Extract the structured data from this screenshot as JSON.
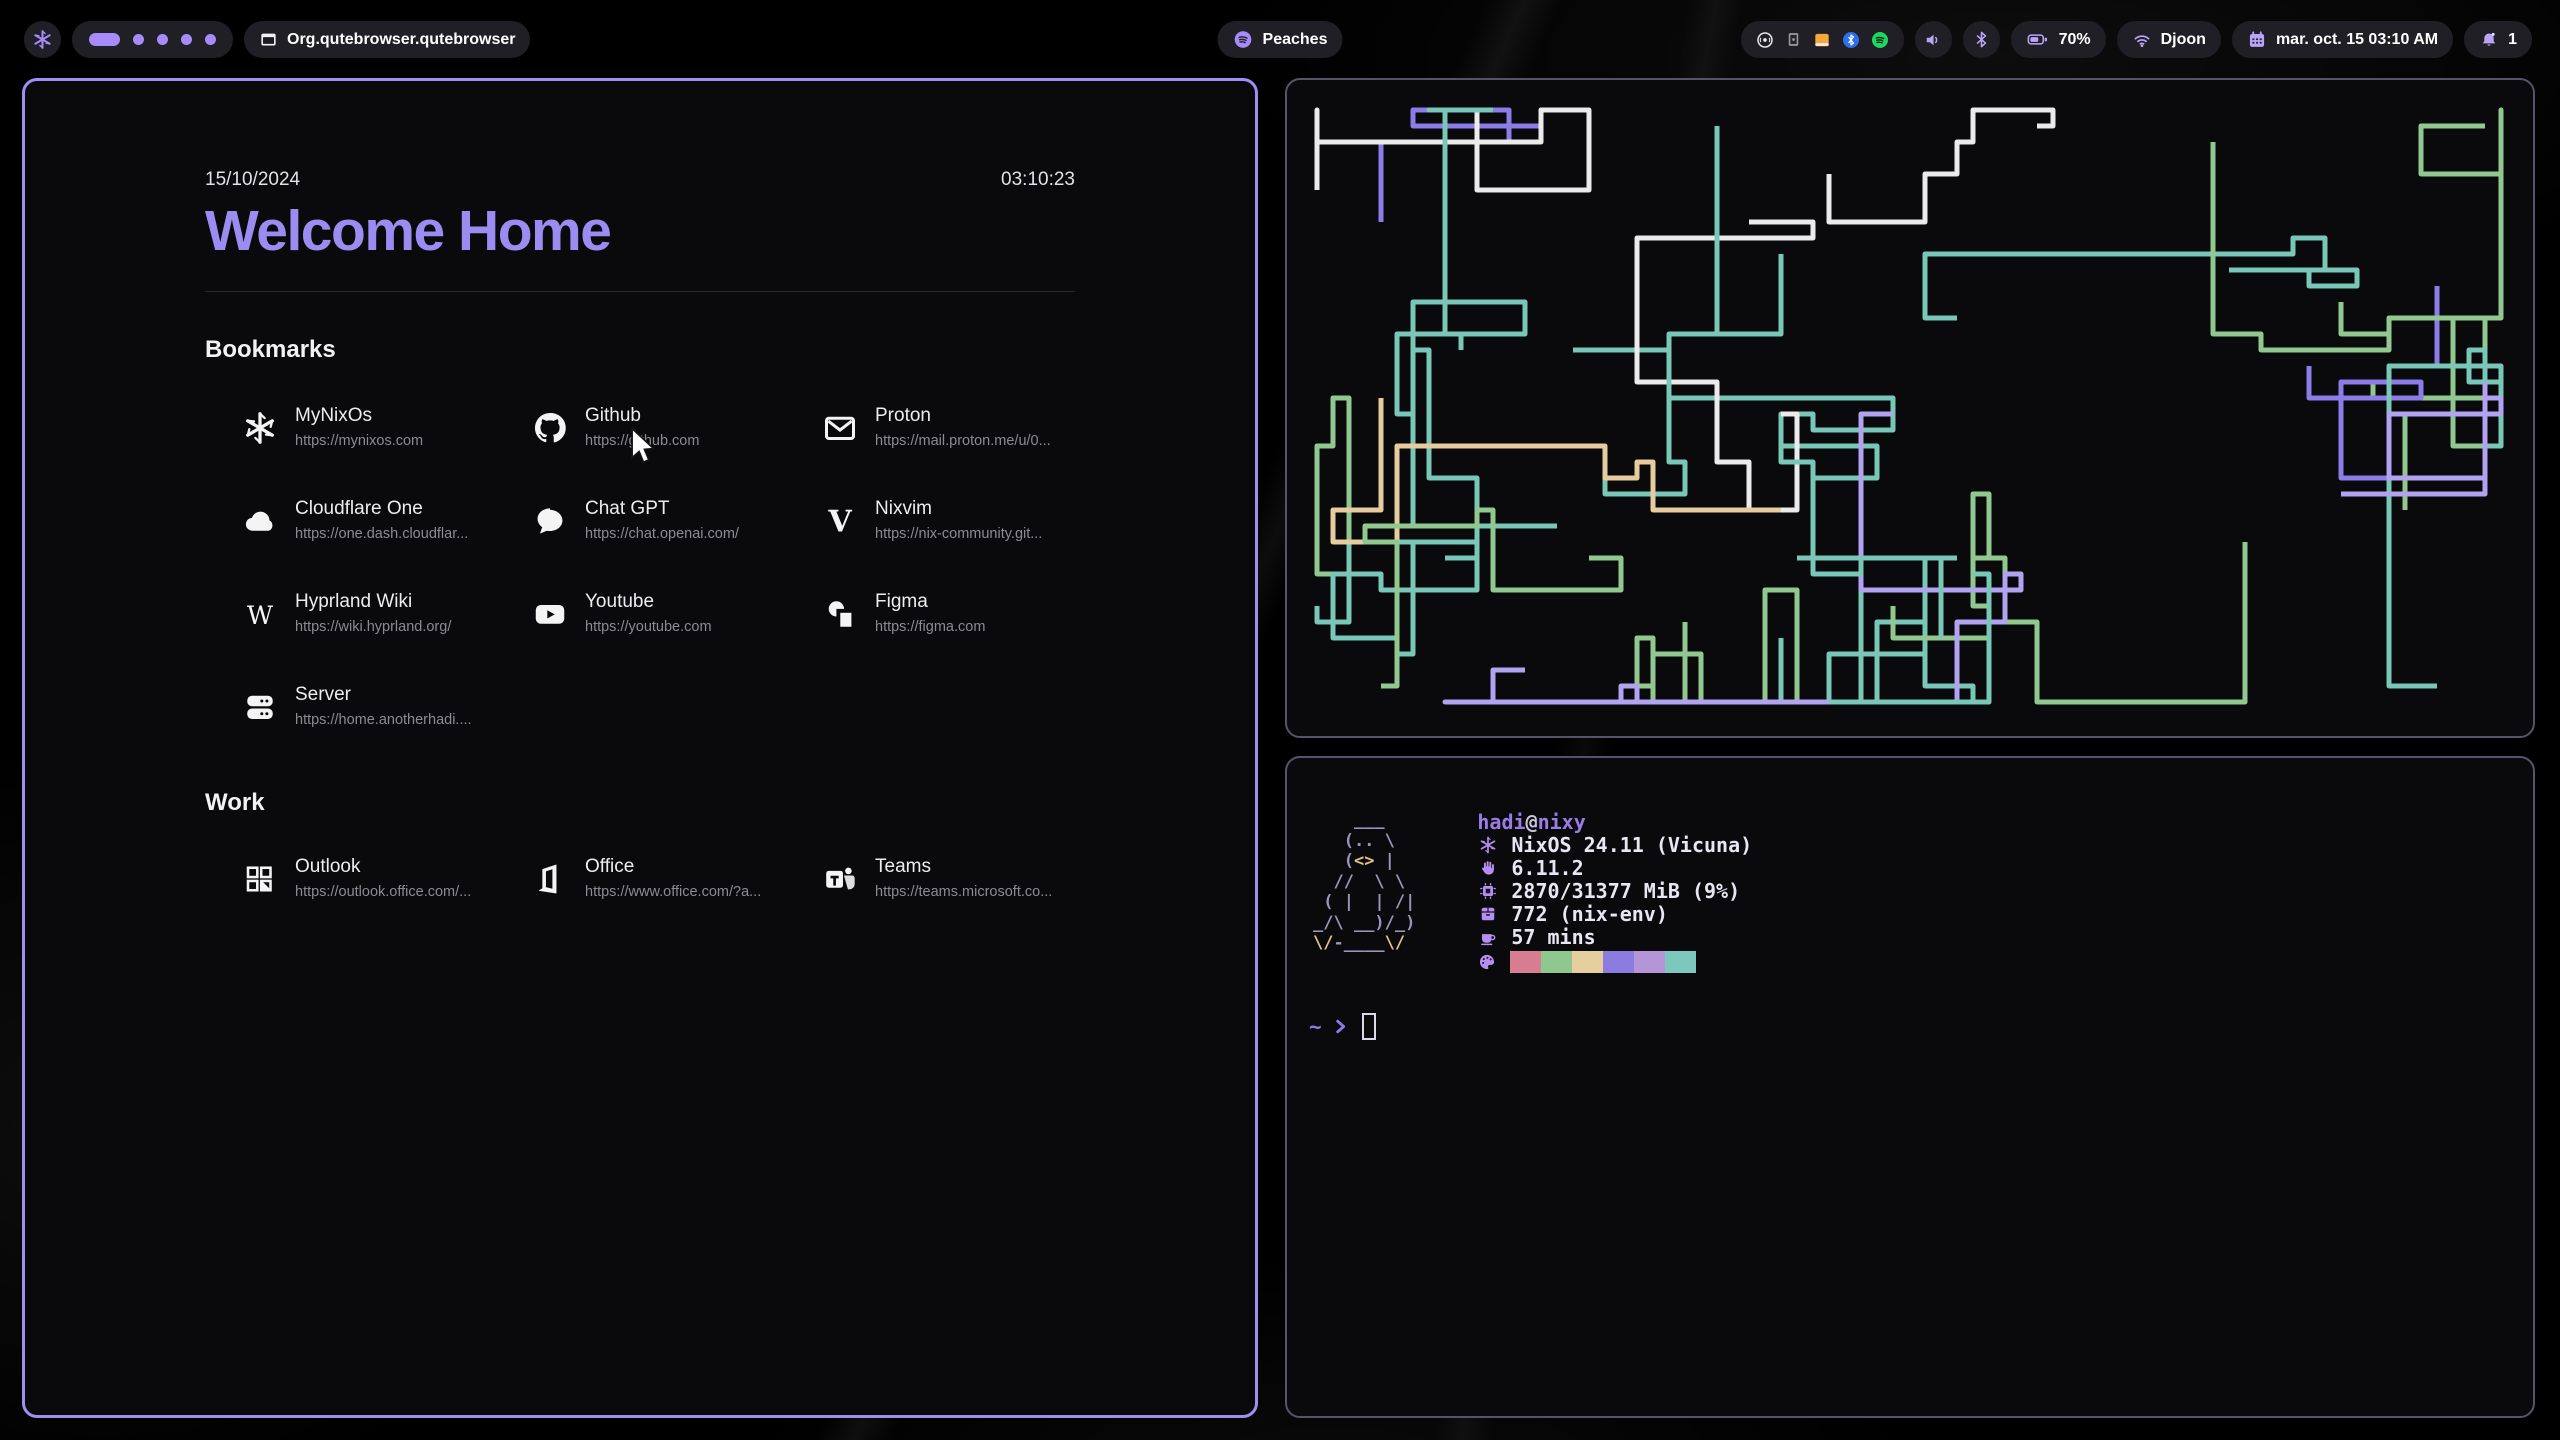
{
  "top_bar": {
    "launcher": {
      "icon": "nixos-logo-icon"
    },
    "workspaces": {
      "active": 1,
      "total": 5
    },
    "window_title": {
      "icon": "window-icon",
      "label": "Org.qutebrowser.qutebrowser"
    },
    "media": {
      "icon": "spotify-icon",
      "label": "Peaches"
    },
    "tray": {
      "icons": [
        "record",
        "device",
        "files",
        "bluetooth",
        "spotify"
      ]
    },
    "battery": {
      "icon": "battery-icon",
      "label": "70%"
    },
    "network": {
      "icon": "wifi-icon",
      "label": "Djoon"
    },
    "clock": {
      "icon": "calendar-icon",
      "label": "mar. oct. 15  03:10 AM"
    },
    "notifications": {
      "icon": "bell-icon",
      "label": "1"
    }
  },
  "startpage": {
    "date": "15/10/2024",
    "time": "03:10:23",
    "title": "Welcome Home",
    "title_color": "#9b8cf2",
    "sections": [
      {
        "heading": "Bookmarks",
        "items": [
          {
            "icon": "mynixos",
            "name": "MyNixOs",
            "url": "https://mynixos.com"
          },
          {
            "icon": "github",
            "name": "Github",
            "url": "https://github.com"
          },
          {
            "icon": "proton",
            "name": "Proton",
            "url": "https://mail.proton.me/u/0..."
          },
          {
            "icon": "cloudflare",
            "name": "Cloudflare One",
            "url": "https://one.dash.cloudflar..."
          },
          {
            "icon": "chatgpt",
            "name": "Chat GPT",
            "url": "https://chat.openai.com/"
          },
          {
            "icon": "nixvim",
            "name": "Nixvim",
            "url": "https://nix-community.git..."
          },
          {
            "icon": "wiki",
            "name": "Hyprland Wiki",
            "url": "https://wiki.hyprland.org/"
          },
          {
            "icon": "youtube",
            "name": "Youtube",
            "url": "https://youtube.com"
          },
          {
            "icon": "figma",
            "name": "Figma",
            "url": "https://figma.com"
          },
          {
            "icon": "server",
            "name": "Server",
            "url": "https://home.anotherhadi...."
          }
        ]
      },
      {
        "heading": "Work",
        "items": [
          {
            "icon": "outlook",
            "name": "Outlook",
            "url": "https://outlook.office.com/..."
          },
          {
            "icon": "office",
            "name": "Office",
            "url": "https://www.office.com/?a..."
          },
          {
            "icon": "teams",
            "name": "Teams",
            "url": "https://teams.microsoft.co..."
          }
        ]
      }
    ]
  },
  "terminal_fetch": {
    "user": "hadi",
    "separator": "@",
    "host": "nixy",
    "info": [
      {
        "icon": "snowflake-icon",
        "text": "NixOS 24.11 (Vicuna)"
      },
      {
        "icon": "kernel-icon",
        "text": "6.11.2"
      },
      {
        "icon": "memory-icon",
        "text": "2870/31377 MiB (9%)"
      },
      {
        "icon": "packages-icon",
        "text": "772 (nix-env)"
      },
      {
        "icon": "uptime-icon",
        "text": "57 mins"
      }
    ],
    "palette": [
      "#d77d92",
      "#8fc88f",
      "#e5cf9f",
      "#8d7ce0",
      "#b495d8",
      "#7dc8bd"
    ],
    "prompt": {
      "path": "~",
      "arrow": "❯"
    },
    "ascii": [
      [
        {
          "t": "    ___",
          "c": "b"
        }
      ],
      [
        {
          "t": "   (.. \\",
          "c": "b"
        }
      ],
      [
        {
          "t": "   (",
          "c": "b"
        },
        {
          "t": "<>",
          "c": "y"
        },
        {
          "t": " |",
          "c": "b"
        }
      ],
      [
        {
          "t": "  //  \\ \\",
          "c": "b"
        }
      ],
      [
        {
          "t": " ( |  | /|",
          "c": "b"
        }
      ],
      [
        {
          "t": "_/\\ __)/_)",
          "c": "b"
        }
      ],
      [
        {
          "t": "\\/",
          "c": "y"
        },
        {
          "t": "-____",
          "c": "b"
        },
        {
          "t": "\\/",
          "c": "y"
        }
      ]
    ]
  },
  "pipes": {
    "colors": [
      "#79c7b6",
      "#79c7b6",
      "#79c7b6",
      "#8b7ce8",
      "#b1a3f0",
      "#90c890",
      "#e6cc9e",
      "#ebebeb",
      "#79c7b6",
      "#8b7ce8",
      "#90c890",
      "#ebebeb"
    ]
  },
  "accent": "#a78bfa"
}
